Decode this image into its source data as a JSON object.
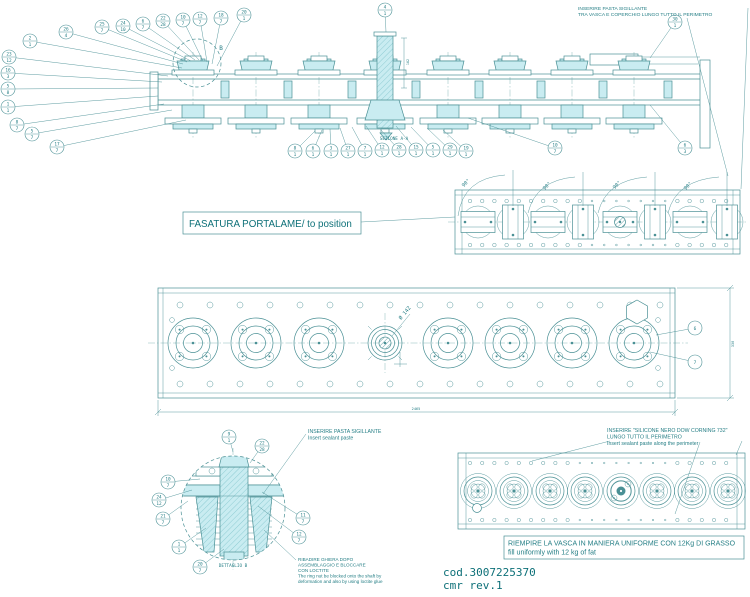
{
  "meta": {
    "code": "cod.3007225370",
    "rev": "cmr rev.1"
  },
  "colors": {
    "line": "#4a9095",
    "fill": "#c9ecf1",
    "text": "#267f86",
    "accent": "#0d7078"
  },
  "labels": {
    "fasatura": "FASATURA PORTALAME/ to position"
  },
  "notes": {
    "seal_top": [
      "INSERIRE PASTA SIGILLANTE",
      "TRA VASCA E COPERCHIO LUNGO TUTTO IL PERIMETRO"
    ],
    "seal_detail": [
      "INSERIRE PASTA SIGILLANTE",
      "Insert sealant paste"
    ],
    "silicone": [
      "INSERIRE \"SILICONE NERO DOW CORNING 732\"",
      "LUNGO TUTTO IL PERIMETRO",
      "Insert sealant paste along the perimeter"
    ],
    "ring_nut": [
      "RIBADIRE GHIERA DOPO",
      "ASSEMBLAGGIO E BLOCCARE",
      "CON LOCTITE",
      "The ring nut be blocked onto the shaft by",
      "deformation and also by using loctite glue"
    ],
    "grease": [
      "RIEMPIRE LA VASCA IN MANIERA UNIFORME CON 12Kg DI GRASSO",
      "fill uniformly with 12 kg of fat"
    ]
  },
  "annotations": [
    {
      "text": "SEZIONE A-A",
      "x": 394,
      "y": 140,
      "rot": 0,
      "size": 4.3
    },
    {
      "text": "DETTAGLIO B",
      "x": 233,
      "y": 567,
      "rot": 0,
      "size": 4.3
    },
    {
      "text": "B",
      "x": 221,
      "y": 50,
      "rot": 0,
      "size": 6
    },
    {
      "text": "90°",
      "x": 467,
      "y": 184,
      "rot": -45,
      "size": 5
    },
    {
      "text": "90°",
      "x": 548,
      "y": 187,
      "rot": -45,
      "size": 5
    },
    {
      "text": "90°",
      "x": 618,
      "y": 186,
      "rot": -45,
      "size": 5
    },
    {
      "text": "90°",
      "x": 689,
      "y": 187,
      "rot": -45,
      "size": 5
    },
    {
      "text": "Ø 142",
      "x": 406,
      "y": 314,
      "rot": -50,
      "size": 5.2
    },
    {
      "text": "2465",
      "x": 416,
      "y": 410,
      "rot": 0,
      "size": 3.6
    },
    {
      "text": "330",
      "x": 734,
      "y": 344,
      "rot": -90,
      "size": 3.6
    },
    {
      "text": "162",
      "x": 409,
      "y": 62,
      "rot": -90,
      "size": 3.4
    }
  ],
  "balloons": [
    {
      "x": 30,
      "y": 41,
      "a": "2",
      "b": "1",
      "lx": 182,
      "ly": 68
    },
    {
      "x": 9,
      "y": 57,
      "a": "23",
      "b": "12",
      "lx": 168,
      "ly": 76
    },
    {
      "x": 8,
      "y": 73,
      "a": "16",
      "b": "3",
      "lx": 162,
      "ly": 82
    },
    {
      "x": 8,
      "y": 89,
      "a": "5",
      "b": "8",
      "lx": 158,
      "ly": 88
    },
    {
      "x": 8,
      "y": 107,
      "a": "1",
      "b": "1",
      "lx": 158,
      "ly": 96
    },
    {
      "x": 17,
      "y": 125,
      "a": "8",
      "b": "7",
      "lx": 164,
      "ly": 104
    },
    {
      "x": 32,
      "y": 134,
      "a": "5",
      "b": "7",
      "lx": 172,
      "ly": 110
    },
    {
      "x": 57,
      "y": 147,
      "a": "17",
      "b": "7",
      "lx": 186,
      "ly": 120
    },
    {
      "x": 66,
      "y": 32,
      "a": "26",
      "b": "4",
      "lx": 183,
      "ly": 64
    },
    {
      "x": 102,
      "y": 27,
      "a": "25",
      "b": "7",
      "lx": 187,
      "ly": 62
    },
    {
      "x": 123,
      "y": 26,
      "a": "24",
      "b": "10",
      "lx": 191,
      "ly": 61
    },
    {
      "x": 143,
      "y": 24,
      "a": "6",
      "b": "7",
      "lx": 195,
      "ly": 60
    },
    {
      "x": 163,
      "y": 21,
      "a": "22",
      "b": "28",
      "lx": 199,
      "ly": 60
    },
    {
      "x": 183,
      "y": 20,
      "a": "10",
      "b": "7",
      "lx": 203,
      "ly": 61
    },
    {
      "x": 200,
      "y": 19,
      "a": "12",
      "b": "7",
      "lx": 207,
      "ly": 62
    },
    {
      "x": 221,
      "y": 18,
      "a": "18",
      "b": "7",
      "lx": 212,
      "ly": 64
    },
    {
      "x": 244,
      "y": 15,
      "a": "20",
      "b": "1",
      "lx": 217,
      "ly": 66
    },
    {
      "x": 385,
      "y": 10,
      "a": "4",
      "b": "1",
      "lx": 386,
      "ly": 32
    },
    {
      "x": 295,
      "y": 151,
      "a": "8",
      "b": "1",
      "lx": 315,
      "ly": 131
    },
    {
      "x": 313,
      "y": 151,
      "a": "6",
      "b": "1",
      "lx": 322,
      "ly": 130
    },
    {
      "x": 331,
      "y": 151,
      "a": "3",
      "b": "1",
      "lx": 330,
      "ly": 129
    },
    {
      "x": 348,
      "y": 151,
      "a": "27",
      "b": "1",
      "lx": 340,
      "ly": 128
    },
    {
      "x": 365,
      "y": 151,
      "a": "7",
      "b": "1",
      "lx": 352,
      "ly": 127
    },
    {
      "x": 382,
      "y": 150,
      "a": "12",
      "b": "1",
      "lx": 366,
      "ly": 126
    },
    {
      "x": 399,
      "y": 150,
      "a": "28",
      "b": "1",
      "lx": 381,
      "ly": 130
    },
    {
      "x": 416,
      "y": 150,
      "a": "15",
      "b": "1",
      "lx": 396,
      "ly": 126
    },
    {
      "x": 433,
      "y": 150,
      "a": "5",
      "b": "1",
      "lx": 411,
      "ly": 127
    },
    {
      "x": 450,
      "y": 150,
      "a": "29",
      "b": "1",
      "lx": 427,
      "ly": 128
    },
    {
      "x": 466,
      "y": 151,
      "a": "19",
      "b": "1",
      "lx": 443,
      "ly": 130
    },
    {
      "x": 555,
      "y": 148,
      "a": "10",
      "b": "7",
      "lx": 468,
      "ly": 118
    },
    {
      "x": 685,
      "y": 148,
      "a": "6",
      "b": "3",
      "lx": 650,
      "ly": 105
    },
    {
      "x": 675,
      "y": 22,
      "a": "30",
      "b": "1",
      "lx": 650,
      "ly": 58
    },
    {
      "x": 695,
      "y": 328,
      "a": "6",
      "b": "",
      "lx": 656,
      "ly": 335
    },
    {
      "x": 695,
      "y": 362,
      "a": "7",
      "b": "",
      "lx": 650,
      "ly": 352
    },
    {
      "x": 229,
      "y": 437,
      "a": "9",
      "b": "1",
      "lx": 233,
      "ly": 452
    },
    {
      "x": 262,
      "y": 446,
      "a": "22",
      "b": "28",
      "lx": 250,
      "ly": 463
    },
    {
      "x": 168,
      "y": 482,
      "a": "10",
      "b": "7",
      "lx": 200,
      "ly": 479
    },
    {
      "x": 159,
      "y": 500,
      "a": "24",
      "b": "12",
      "lx": 192,
      "ly": 490
    },
    {
      "x": 163,
      "y": 519,
      "a": "21",
      "b": "7",
      "lx": 188,
      "ly": 501
    },
    {
      "x": 179,
      "y": 547,
      "a": "1",
      "b": "1",
      "lx": 206,
      "ly": 528
    },
    {
      "x": 200,
      "y": 567,
      "a": "20",
      "b": "7",
      "lx": 224,
      "ly": 549
    },
    {
      "x": 303,
      "y": 518,
      "a": "11",
      "b": "7",
      "lx": 262,
      "ly": 492
    },
    {
      "x": 299,
      "y": 537,
      "a": "12",
      "b": "7",
      "lx": 258,
      "ly": 506
    }
  ]
}
